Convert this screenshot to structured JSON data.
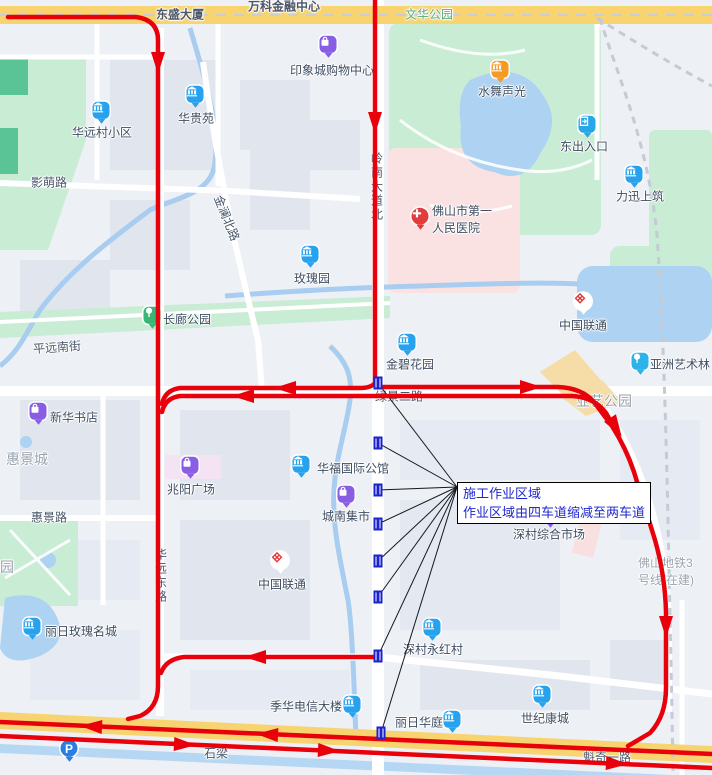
{
  "map": {
    "colors": {
      "route_red": "#e8000a",
      "marker_blue": "#1a23cc",
      "callout_text_blue": "#1f27cc",
      "park_green": "#c9ecd4",
      "water_blue": "#aed3f2",
      "major_road_yellow": "#f7d470"
    },
    "callout": {
      "lines": [
        "施工作业区域",
        "作业区域由四车道缩减至两车道"
      ],
      "x": 457,
      "y": 482,
      "anchor": {
        "x": 457,
        "y": 487
      }
    },
    "construction_markers": [
      {
        "x": 378,
        "y": 383
      },
      {
        "x": 378,
        "y": 443
      },
      {
        "x": 378,
        "y": 490
      },
      {
        "x": 378,
        "y": 524
      },
      {
        "x": 378,
        "y": 561
      },
      {
        "x": 378,
        "y": 597
      },
      {
        "x": 378,
        "y": 656
      },
      {
        "x": 381,
        "y": 733
      }
    ],
    "road_labels": [
      {
        "id": "dongsheng-building",
        "text": "东盛大厦",
        "x": 180,
        "y": 14,
        "kind": "onroad"
      },
      {
        "id": "wanke-financial-center",
        "text": "万科金融中心",
        "x": 284,
        "y": 6,
        "kind": "onroad"
      },
      {
        "id": "wenhua-park",
        "text": "文华公园",
        "x": 429,
        "y": 14,
        "kind": "parkname"
      },
      {
        "id": "yingmeng-road",
        "text": "影萌路",
        "x": 49,
        "y": 182,
        "kind": "road"
      },
      {
        "id": "jinlan-north-road",
        "text": "金澜北路",
        "x": 227,
        "y": 218,
        "kind": "road",
        "rotate": 68
      },
      {
        "id": "lingnan-avenue-north",
        "text": "岭南大道北",
        "x": 377,
        "y": 187,
        "kind": "road",
        "vertical": true
      },
      {
        "id": "pingyuan-south-street",
        "text": "平远南街",
        "x": 57,
        "y": 347,
        "kind": "road",
        "rotate": -4
      },
      {
        "id": "huijing-city",
        "text": "惠景城",
        "x": 27,
        "y": 459,
        "kind": "area"
      },
      {
        "id": "yayi-park",
        "text": "亚艺公园",
        "x": 604,
        "y": 401,
        "kind": "area"
      },
      {
        "id": "lvjing-2nd-road",
        "text": "绿景二路",
        "x": 399,
        "y": 396,
        "kind": "road"
      },
      {
        "id": "huijing-road",
        "text": "惠景路",
        "x": 49,
        "y": 517,
        "kind": "road"
      },
      {
        "id": "huayuan-east-road",
        "text": "华远东路",
        "x": 161,
        "y": 576,
        "kind": "road",
        "vertical": true
      },
      {
        "id": "metro-line-3",
        "lines": [
          "佛山地铁3",
          "号线(在建)"
        ],
        "x": 638,
        "y": 571,
        "kind": "metro",
        "align": "left"
      },
      {
        "id": "shiliang",
        "text": "石梁",
        "x": 216,
        "y": 753,
        "kind": "road"
      },
      {
        "id": "kuiqi-1st-road",
        "text": "魁奇一路",
        "x": 607,
        "y": 757,
        "kind": "road"
      },
      {
        "id": "park-partial",
        "text": "园",
        "x": 7,
        "y": 567,
        "kind": "area"
      }
    ],
    "pois": [
      {
        "id": "yinxiangcheng-shopping-center",
        "label": "印象城购物中心",
        "kind": "mall",
        "icon": {
          "x": 328,
          "y": 46
        },
        "text": {
          "x": 332,
          "y": 70
        }
      },
      {
        "id": "huayuancun-residential",
        "label": "华远村小区",
        "kind": "building",
        "icon": {
          "x": 101,
          "y": 112
        },
        "text": {
          "x": 102,
          "y": 132
        }
      },
      {
        "id": "huaguiyuan",
        "label": "华贵苑",
        "kind": "building",
        "icon": {
          "x": 195,
          "y": 96
        },
        "text": {
          "x": 196,
          "y": 118
        }
      },
      {
        "id": "shuiwu-shengguang",
        "label": "水舞声光",
        "kind": "attraction",
        "icon": {
          "x": 500,
          "y": 71
        },
        "text": {
          "x": 502,
          "y": 91
        }
      },
      {
        "id": "east-entrance",
        "label": "东出入口",
        "kind": "exit",
        "icon": {
          "x": 587,
          "y": 126
        },
        "text": {
          "x": 584,
          "y": 146
        }
      },
      {
        "id": "lixun-shangzhu",
        "label": "力迅上筑",
        "kind": "building",
        "icon": {
          "x": 634,
          "y": 176
        },
        "text": {
          "x": 640,
          "y": 196
        }
      },
      {
        "id": "foshan-first-peoples-hospital",
        "label": "佛山市第一人民医院",
        "lines": [
          "佛山市第一",
          "人民医院"
        ],
        "kind": "hospital",
        "icon": {
          "x": 420,
          "y": 218
        },
        "text": {
          "x": 432,
          "y": 219,
          "align": "left"
        }
      },
      {
        "id": "meiguiyuan",
        "label": "玫瑰园",
        "kind": "building",
        "icon": {
          "x": 310,
          "y": 256
        },
        "text": {
          "x": 312,
          "y": 278
        }
      },
      {
        "id": "changlang-park",
        "label": "长廊公园",
        "kind": "park",
        "icon": {
          "x": 152,
          "y": 317
        },
        "text": {
          "x": 187,
          "y": 319
        }
      },
      {
        "id": "china-unicom-north",
        "label": "中国联通",
        "kind": "unicom",
        "icon": {
          "x": 583,
          "y": 303
        },
        "text": {
          "x": 583,
          "y": 325
        }
      },
      {
        "id": "asian-art-forest",
        "label": "亚洲艺术林",
        "kind": "tree",
        "icon": {
          "x": 640,
          "y": 363
        },
        "text": {
          "x": 680,
          "y": 364
        }
      },
      {
        "id": "jinbi-garden",
        "label": "金碧花园",
        "kind": "building",
        "icon": {
          "x": 407,
          "y": 344
        },
        "text": {
          "x": 410,
          "y": 364
        }
      },
      {
        "id": "xinhua-bookstore",
        "label": "新华书店",
        "kind": "mall",
        "icon": {
          "x": 38,
          "y": 413
        },
        "text": {
          "x": 74,
          "y": 417
        }
      },
      {
        "id": "zhaoyang-plaza",
        "label": "兆阳广场",
        "kind": "mall",
        "icon": {
          "x": 190,
          "y": 467
        },
        "text": {
          "x": 191,
          "y": 489
        }
      },
      {
        "id": "huafu-international-mansion",
        "label": "华福国际公馆",
        "kind": "building",
        "icon": {
          "x": 301,
          "y": 466
        },
        "text": {
          "x": 353,
          "y": 468
        }
      },
      {
        "id": "chengnan-market",
        "label": "城南集市",
        "kind": "mall",
        "icon": {
          "x": 346,
          "y": 496
        },
        "text": {
          "x": 346,
          "y": 516
        }
      },
      {
        "id": "china-unicom-south",
        "label": "中国联通",
        "kind": "unicom",
        "icon": {
          "x": 280,
          "y": 562
        },
        "text": {
          "x": 282,
          "y": 584
        }
      },
      {
        "id": "shencun-comprehensive-market",
        "label": "深村综合市场",
        "kind": "mall",
        "icon": {
          "x": 550,
          "y": 516
        },
        "text": {
          "x": 549,
          "y": 534
        }
      },
      {
        "id": "shencun-yonghong-village",
        "label": "深村永红村",
        "kind": "building",
        "icon": {
          "x": 432,
          "y": 629
        },
        "text": {
          "x": 433,
          "y": 649
        }
      },
      {
        "id": "liri-rose-city",
        "label": "丽日玫瑰名城",
        "kind": "building",
        "icon": {
          "x": 32,
          "y": 628
        },
        "text": {
          "x": 81,
          "y": 631
        }
      },
      {
        "id": "jihua-telecom-building",
        "label": "季华电信大楼",
        "kind": "telecom",
        "icon": {
          "x": 352,
          "y": 706
        },
        "text": {
          "x": 306,
          "y": 706
        }
      },
      {
        "id": "liri-huating",
        "label": "丽日华庭",
        "kind": "building",
        "icon": {
          "x": 452,
          "y": 721
        },
        "text": {
          "x": 419,
          "y": 722
        }
      },
      {
        "id": "shiji-kangcheng",
        "label": "世纪康城",
        "kind": "building",
        "icon": {
          "x": 542,
          "y": 696
        },
        "text": {
          "x": 545,
          "y": 718
        }
      },
      {
        "id": "parking",
        "label": "P",
        "kind": "parking",
        "icon": {
          "x": 69,
          "y": 750
        }
      }
    ]
  }
}
